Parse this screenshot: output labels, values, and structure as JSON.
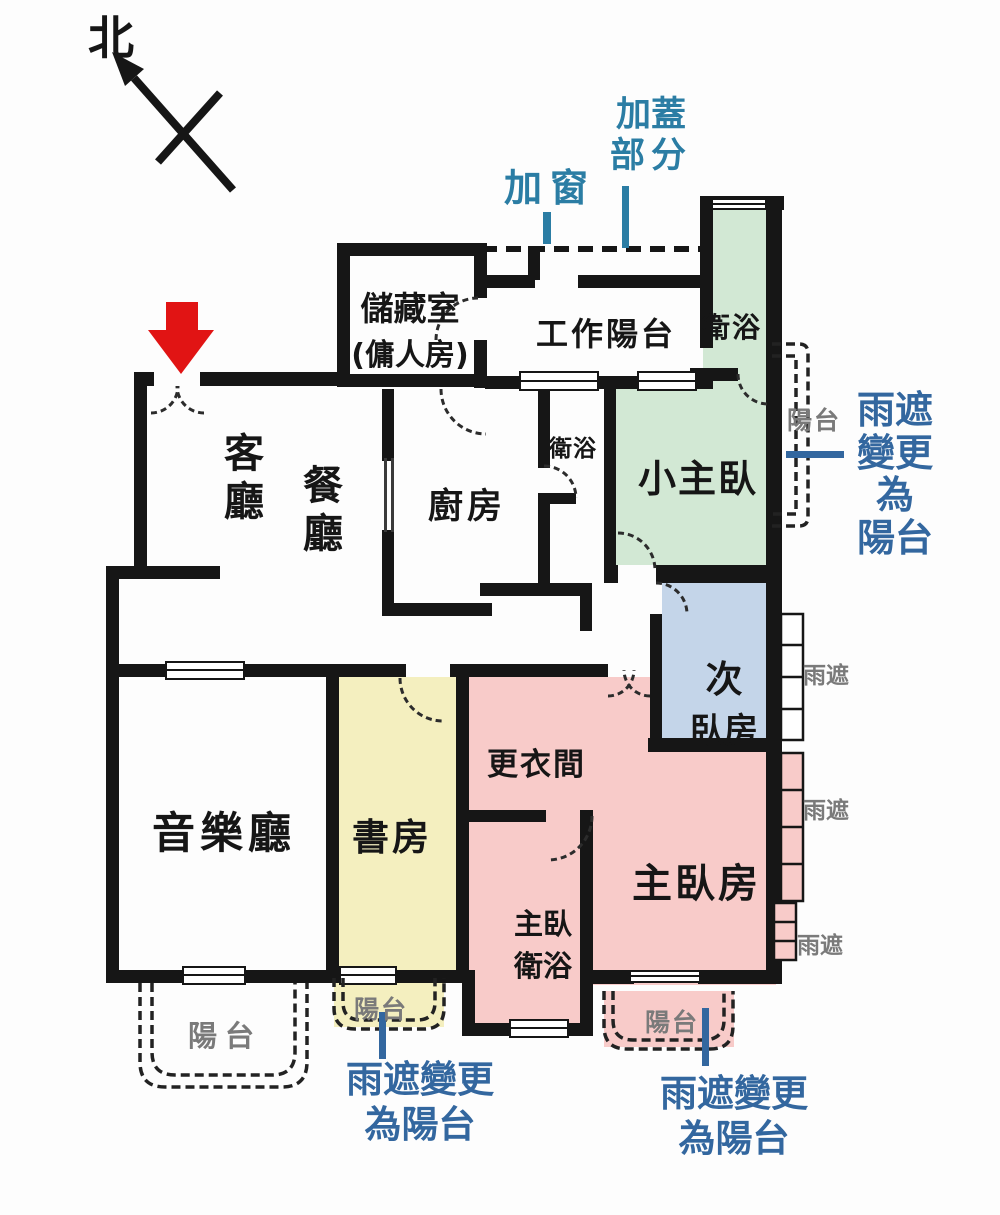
{
  "compass": {
    "north": "北"
  },
  "rooms": {
    "living": "客廳",
    "dining": "餐廳",
    "kitchen": "廚房",
    "storage_line1": "儲藏室",
    "storage_line2": "(傭人房)",
    "work_balcony": "工作陽台",
    "bath_upper": "衛浴",
    "bath_middle": "衛浴",
    "small_master": "小主臥",
    "second_bedroom_line1": "次",
    "second_bedroom_line2": "臥房",
    "dressing_room": "更衣間",
    "master_bedroom": "主臥房",
    "master_bath_line1": "主臥",
    "master_bath_line2": "衛浴",
    "study": "書房",
    "music_hall": "音樂廳"
  },
  "balconies": {
    "left": "陽台",
    "study": "陽台",
    "master": "陽台",
    "right_strip": "陽台"
  },
  "rain_shields": {
    "shield1": "雨遮",
    "shield2": "雨遮",
    "shield3": "雨遮"
  },
  "annotations": {
    "added_window": "加窗",
    "added_cover_line1": "加蓋",
    "added_cover_line2": "部分",
    "right_change_line1": "雨遮",
    "right_change_line2": "變更",
    "right_change_line3": "為",
    "right_change_line4": "陽台",
    "bottom_left_change_line1": "雨遮變更",
    "bottom_left_change_line2": "為陽台",
    "bottom_right_change_line1": "雨遮變更",
    "bottom_right_change_line2": "為陽台"
  },
  "colors": {
    "wall": "#161616",
    "room_green": "#d2e8d4",
    "room_blue": "#c4d5e9",
    "room_pink": "#f8cbc9",
    "room_yellow": "#f4efbf",
    "annotation_teal": "#2b7da4",
    "annotation_blue": "#33679f",
    "gray_label": "#7a7a7a",
    "entry_arrow_red": "#e11414"
  }
}
